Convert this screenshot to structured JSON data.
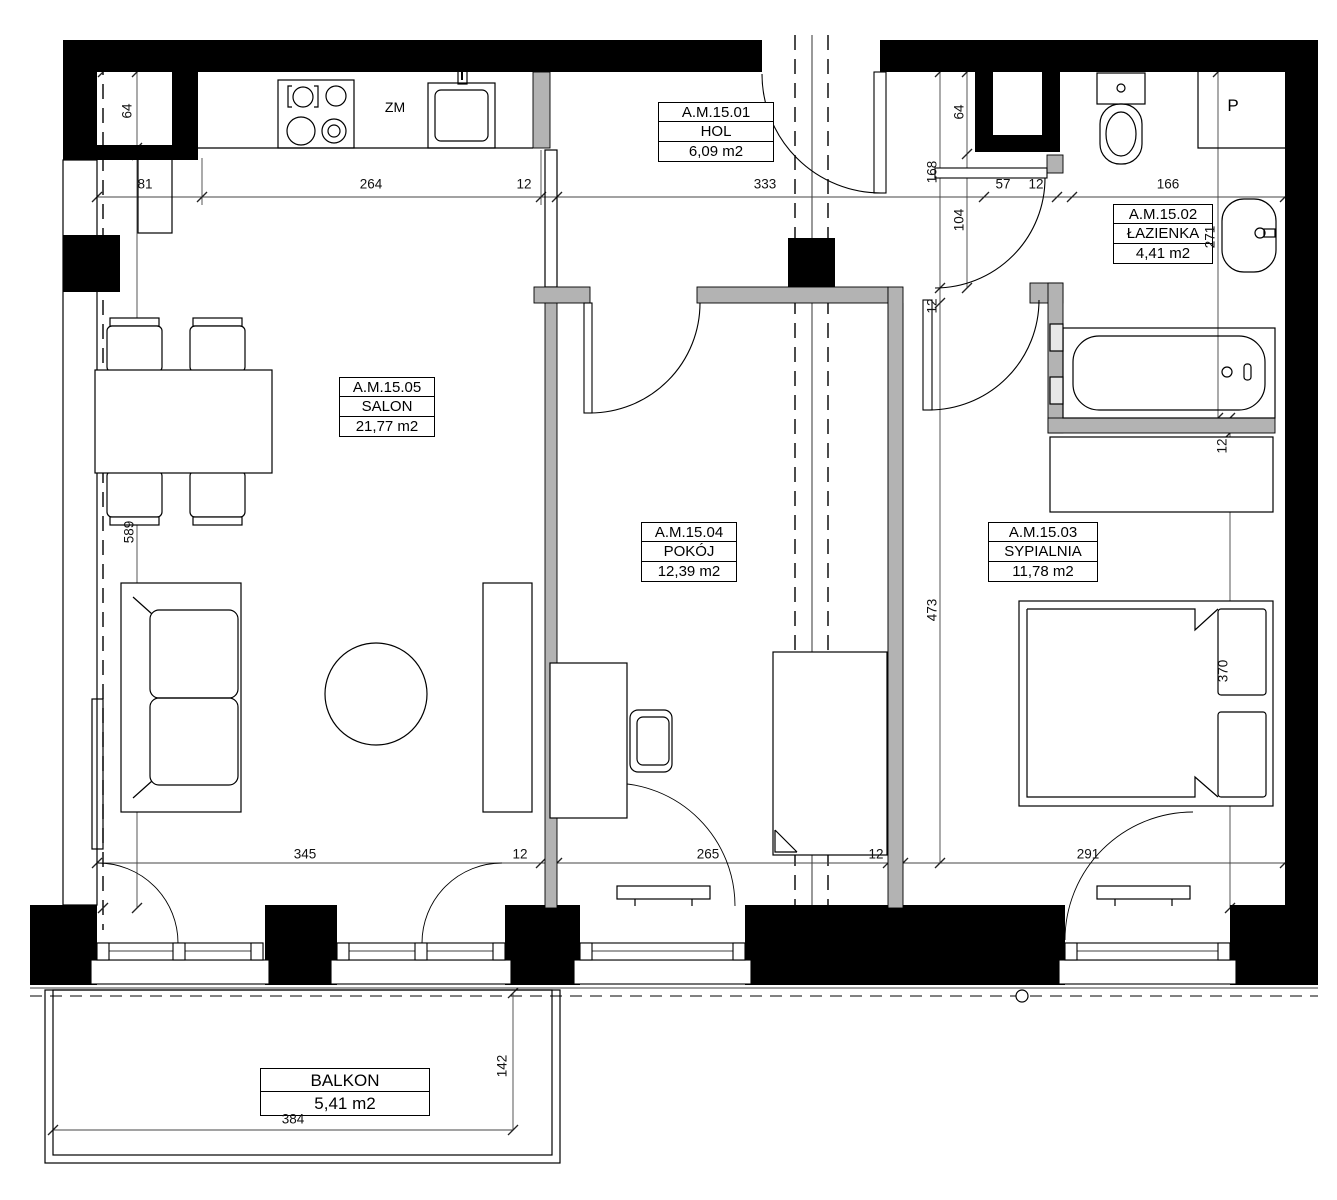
{
  "plan": {
    "rooms": [
      {
        "id": "A.M.15.01",
        "name": "HOL",
        "area": "6,09 m2"
      },
      {
        "id": "A.M.15.02",
        "name": "ŁAZIENKA",
        "area": "4,41 m2"
      },
      {
        "id": "A.M.15.03",
        "name": "SYPIALNIA",
        "area": "11,78 m2"
      },
      {
        "id": "A.M.15.04",
        "name": "POKÓJ",
        "area": "12,39 m2"
      },
      {
        "id": "A.M.15.05",
        "name": "SALON",
        "area": "21,77 m2"
      },
      {
        "name": "BALKON",
        "area": "5,41 m2"
      }
    ],
    "annotations": {
      "kitchen_zm": "ZM",
      "shaft_p": "P"
    },
    "dims": {
      "top": [
        "81",
        "264",
        "12",
        "333",
        "57",
        "12",
        "166"
      ],
      "bottom": [
        "345",
        "12",
        "265",
        "12",
        "291"
      ],
      "vertical": [
        "64",
        "589",
        "168",
        "64",
        "104",
        "12",
        "473",
        "271",
        "12",
        "370",
        "142"
      ],
      "balcony": [
        "384"
      ]
    },
    "colors": {
      "wall": "#000000",
      "partition": "#b3b3b3",
      "line": "#1a1a1a",
      "dimline": "#444444"
    }
  }
}
